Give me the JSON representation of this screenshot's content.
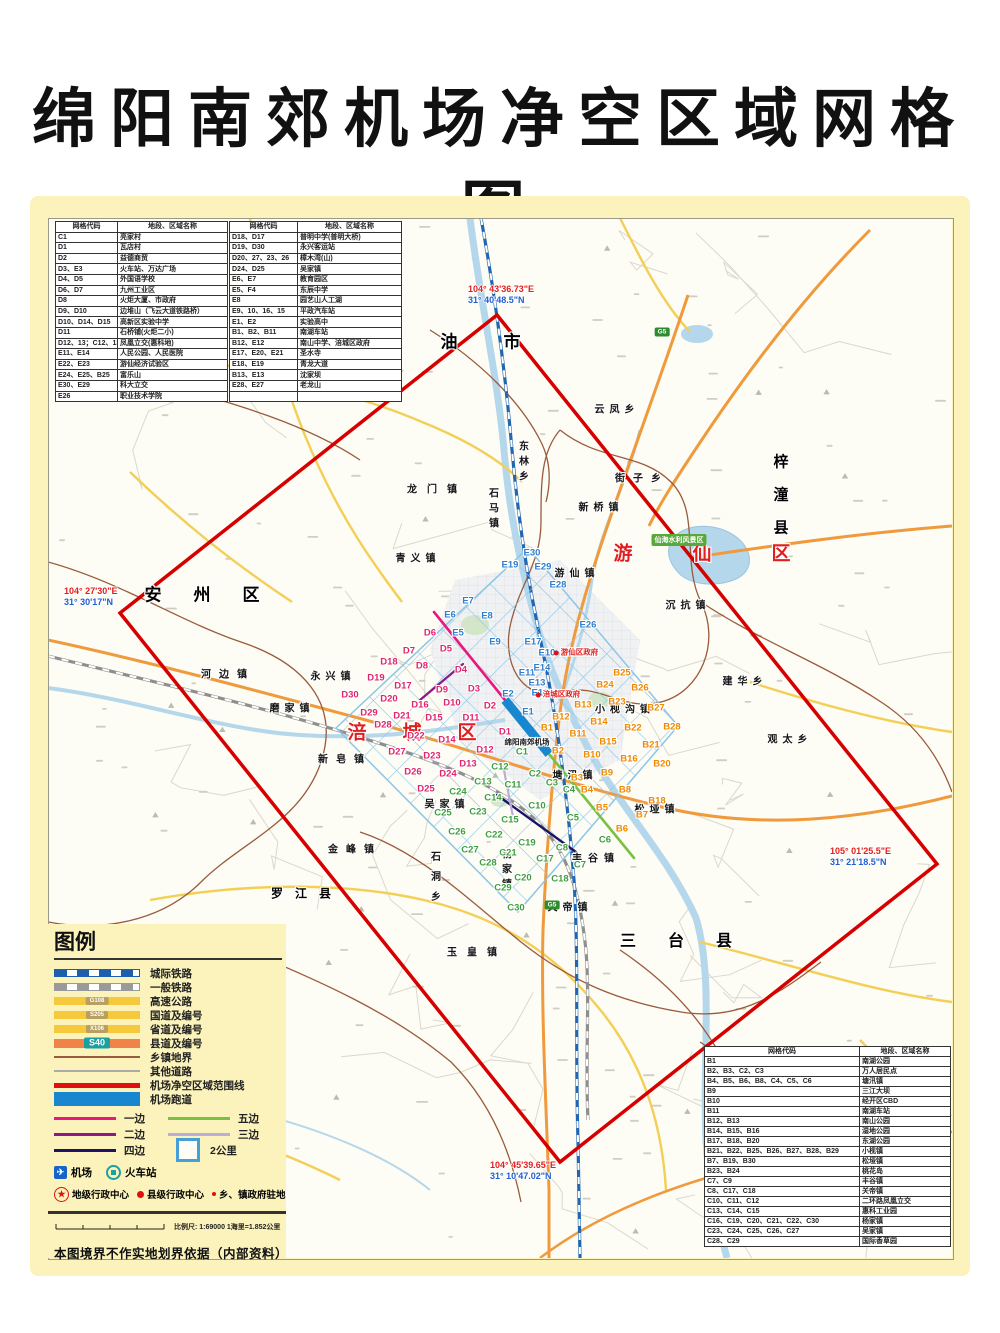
{
  "title": "绵阳南郊机场净空区域网格图",
  "palette": {
    "page_bg": "#fbf3bb",
    "boundary_red": "#d60000",
    "grid_blue": "#8cc6e6",
    "runway_blue": "#1887d0",
    "edge1_pink": "#e8197d",
    "edge2_purple": "#8b1a89",
    "edge3_lavender": "#b9aed6",
    "edge4_navy": "#1b1464",
    "edge5_green": "#7ac143",
    "d_label": "#e0256e",
    "e_label": "#2f7fd0",
    "b_label": "#ef8a00",
    "c_label": "#3f9e3f",
    "highway_orange": "#ef9a3c",
    "road_yellow": "#f6c93c",
    "river_blue": "#b5d7ec",
    "boundary_brown": "#9a5b3c"
  },
  "tables": {
    "headers": [
      "网格代码",
      "地段、区域名称"
    ],
    "top_left_rows": [
      [
        "C1",
        "亮家村"
      ],
      [
        "D1",
        "瓦店村"
      ],
      [
        "D2",
        "益德商贸"
      ],
      [
        "D3、E3",
        "火车站、万达广场"
      ],
      [
        "D4、D5",
        "外国语学校"
      ],
      [
        "D6、D7",
        "九州工业区"
      ],
      [
        "D8",
        "火炬大厦、市政府"
      ],
      [
        "D9、D10",
        "边堆山（飞云大道铁路桥）"
      ],
      [
        "D10、D14、D15",
        "高新区实验中学"
      ],
      [
        "D11",
        "石桥铺(火炬二小)"
      ],
      [
        "D12、13；C12、13",
        "凤凰立交(惠科地)"
      ],
      [
        "E11、E14",
        "人民公园、人民医院"
      ],
      [
        "E22、E23",
        "游仙经济试验区"
      ],
      [
        "E24、E25、B25",
        "富乐山"
      ],
      [
        "E30、E29",
        "科大立交"
      ],
      [
        "E26",
        "职业技术学院"
      ]
    ],
    "top_mid_rows": [
      [
        "D18、D17",
        "普明中学(普明大桥)"
      ],
      [
        "D19、D30",
        "永兴客运站"
      ],
      [
        "D20、27、23、26",
        "樟木湾(山)"
      ],
      [
        "D24、D25",
        "吴家镇"
      ],
      [
        "E6、E7",
        "教育园区"
      ],
      [
        "E5、F4",
        "东辰中学"
      ],
      [
        "E8",
        "园艺山人工湖"
      ],
      [
        "E9、10、16、15",
        "平政汽车站"
      ],
      [
        "E1、E2",
        "实验高中"
      ],
      [
        "B1、B2、B11",
        "南湖车站"
      ],
      [
        "B12、E12",
        "南山中学、涪城区政府"
      ],
      [
        "E17、E20、E21",
        "圣水寺"
      ],
      [
        "E18、E19",
        "青龙大道"
      ],
      [
        "B13、E13",
        "沈家坝"
      ],
      [
        "E28、E27",
        "老龙山"
      ],
      [
        "",
        ""
      ]
    ],
    "bottom_right_rows": [
      [
        "B1",
        "南湖公园"
      ],
      [
        "B2、B3、C2、C3",
        "万人居民点"
      ],
      [
        "B4、B5、B6、B8、C4、C5、C6",
        "塘汛镇"
      ],
      [
        "B9",
        "三江大坝"
      ],
      [
        "B10",
        "经开区CBD"
      ],
      [
        "B11",
        "南湖车站"
      ],
      [
        "B12、B13",
        "南山公园"
      ],
      [
        "B14、B15、B16",
        "湿地公园"
      ],
      [
        "B17、B18、B20",
        "东湖公园"
      ],
      [
        "B21、B22、B25、B26、B27、B28、B29",
        "小枧镇"
      ],
      [
        "B7、B19、B30",
        "松垭镇"
      ],
      [
        "B23、B24",
        "桃花岛"
      ],
      [
        "C7、C9",
        "丰谷镇"
      ],
      [
        "C8、C17、C18",
        "关帝镇"
      ],
      [
        "C10、C11、C12",
        "二环路凤凰立交"
      ],
      [
        "C13、C14、C15",
        "惠科工业园"
      ],
      [
        "C16、C19、C20、C21、C22、C30",
        "杨家镇"
      ],
      [
        "C23、C24、C25、C26、C27",
        "吴家镇"
      ],
      [
        "C28、C29",
        "国际香草园"
      ]
    ]
  },
  "legend": {
    "title": "图例",
    "lines": [
      {
        "label": "城际铁路",
        "type": "rail-blue"
      },
      {
        "label": "一般铁路",
        "type": "rail-gray"
      },
      {
        "label": "高速公路",
        "type": "road-yellow",
        "badge": "G108",
        "badgeType": "tan"
      },
      {
        "label": "国道及编号",
        "type": "road-yellow",
        "badge": "S205",
        "badgeType": "tan"
      },
      {
        "label": "省道及编号",
        "type": "road-yellow",
        "badge": "X106",
        "badgeType": "tan"
      },
      {
        "label": "县道及编号",
        "type": "road-orange",
        "badge": "S40",
        "badgeType": "teal"
      },
      {
        "label": "乡镇地界",
        "type": "line-brown"
      },
      {
        "label": "其他道路",
        "type": "line-gray"
      },
      {
        "label": "机场净空区域范围线",
        "type": "line-red"
      },
      {
        "label": "机场跑道",
        "type": "runway-sw"
      }
    ],
    "edges": [
      {
        "label": "一边",
        "color": "#e8197d"
      },
      {
        "label": "五边",
        "color": "#7ac143"
      },
      {
        "label": "二边",
        "color": "#8b1a89"
      },
      {
        "label": "三边",
        "color": "#b9aed6"
      },
      {
        "label": "四边",
        "color": "#1b1464"
      }
    ],
    "cell_label": "2公里",
    "poi": [
      {
        "label": "机场",
        "icon": "airport-icon"
      },
      {
        "label": "火车站",
        "icon": "train-station-icon"
      }
    ],
    "admin": [
      {
        "label": "地级行政中心",
        "icon": "star-icon"
      },
      {
        "label": "县级行政中心",
        "icon": "dot-large-icon"
      },
      {
        "label": "乡、镇政府驻地",
        "icon": "dot-small-icon"
      }
    ],
    "scale_label": "比例尺: 1:69000  1海里=1.852公里",
    "disclaimer": "本图境界不作实地划界依据（内部资料）"
  },
  "map": {
    "corner_coordinates": [
      {
        "e": "104° 43'36.73\"E",
        "n": "31° 40'48.5\"N",
        "x": 468,
        "y": 284
      },
      {
        "e": "104° 27'30\"E",
        "n": "31° 30'17\"N",
        "x": 64,
        "y": 586
      },
      {
        "e": "105° 01'25.5\"E",
        "n": "31° 21'18.5\"N",
        "x": 830,
        "y": 846
      },
      {
        "e": "104° 45'39.65\"E",
        "n": "31° 10'47.02\"N",
        "x": 490,
        "y": 1160
      }
    ],
    "regions": [
      {
        "t": "江油市",
        "x": 472,
        "y": 340,
        "fs": 17,
        "ls": 46,
        "cls": "county"
      },
      {
        "t": "安州区",
        "x": 218,
        "y": 593,
        "fs": 17,
        "ls": 32,
        "cls": "county"
      },
      {
        "t": "游仙区",
        "x": 732,
        "y": 552,
        "fs": 19,
        "ls": 60,
        "cls": "district"
      },
      {
        "t": "涪城区",
        "x": 430,
        "y": 731,
        "fs": 19,
        "ls": 36,
        "cls": "district"
      },
      {
        "t": "梓潼县",
        "x": 780,
        "y": 503,
        "fs": 15,
        "ls": 18,
        "cls": "county",
        "v": 1
      },
      {
        "t": "三台县",
        "x": 692,
        "y": 939,
        "fs": 16,
        "ls": 32,
        "cls": "county"
      },
      {
        "t": "罗江县",
        "x": 307,
        "y": 893,
        "fs": 12,
        "ls": 12,
        "cls": "county"
      }
    ],
    "towns": [
      {
        "t": "云凤乡",
        "x": 617,
        "y": 408
      },
      {
        "t": "东林乡",
        "x": 522,
        "y": 463,
        "v": 1
      },
      {
        "t": "龙门镇",
        "x": 437,
        "y": 488,
        "ls": 10
      },
      {
        "t": "石马镇",
        "x": 492,
        "y": 510,
        "v": 1
      },
      {
        "t": "新桥镇",
        "x": 601,
        "y": 506
      },
      {
        "t": "街子乡",
        "x": 642,
        "y": 477,
        "ls": 8
      },
      {
        "t": "青义镇",
        "x": 418,
        "y": 557
      },
      {
        "t": "游仙镇",
        "x": 577,
        "y": 572
      },
      {
        "t": "沉抗镇",
        "x": 688,
        "y": 604
      },
      {
        "t": "河边镇",
        "x": 228,
        "y": 673,
        "ls": 8
      },
      {
        "t": "永兴镇",
        "x": 333,
        "y": 675
      },
      {
        "t": "磨家镇",
        "x": 292,
        "y": 707
      },
      {
        "t": "新皂镇",
        "x": 345,
        "y": 758,
        "ls": 8
      },
      {
        "t": "吴家镇",
        "x": 447,
        "y": 803
      },
      {
        "t": "金峰镇",
        "x": 355,
        "y": 848,
        "ls": 8
      },
      {
        "t": "石洞乡",
        "x": 434,
        "y": 881,
        "v": 1,
        "ls": 10
      },
      {
        "t": "玉皇镇",
        "x": 477,
        "y": 951,
        "ls": 10
      },
      {
        "t": "杨家镇",
        "x": 505,
        "y": 871,
        "v": 1
      },
      {
        "t": "丰谷镇",
        "x": 596,
        "y": 857,
        "ls": 6
      },
      {
        "t": "关帝镇",
        "x": 570,
        "y": 906
      },
      {
        "t": "塘汛镇",
        "x": 575,
        "y": 774
      },
      {
        "t": "小枧沟镇",
        "x": 625,
        "y": 708
      },
      {
        "t": "松垭镇",
        "x": 657,
        "y": 808
      },
      {
        "t": "建华乡",
        "x": 745,
        "y": 680
      },
      {
        "t": "观太乡",
        "x": 790,
        "y": 738
      }
    ],
    "special": [
      {
        "t": "仙海水利风景区",
        "x": 679,
        "y": 540,
        "cls": "green-badge"
      },
      {
        "t": "绵阳南郊机场",
        "x": 527,
        "y": 742,
        "cls": "tiny-black"
      },
      {
        "t": "游仙区政府",
        "x": 576,
        "y": 652,
        "cls": "tiny-red",
        "dot": 1
      },
      {
        "t": "涪城区政府",
        "x": 558,
        "y": 694,
        "cls": "tiny-red",
        "dot": 1
      }
    ],
    "road_badges": [
      {
        "t": "G5",
        "x": 662,
        "y": 332
      },
      {
        "t": "G5",
        "x": 552,
        "y": 905
      }
    ],
    "grid_labels": {
      "d": [
        [
          "D1",
          505,
          732
        ],
        [
          "D2",
          490,
          706
        ],
        [
          "D3",
          474,
          689
        ],
        [
          "D4",
          461,
          670
        ],
        [
          "D5",
          446,
          649
        ],
        [
          "D6",
          430,
          633
        ],
        [
          "D7",
          409,
          651
        ],
        [
          "D8",
          422,
          666
        ],
        [
          "D9",
          442,
          690
        ],
        [
          "D10",
          452,
          703
        ],
        [
          "D11",
          471,
          718
        ],
        [
          "D12",
          485,
          750
        ],
        [
          "D13",
          468,
          764
        ],
        [
          "D14",
          447,
          740
        ],
        [
          "D15",
          434,
          718
        ],
        [
          "D16",
          420,
          705
        ],
        [
          "D17",
          403,
          686
        ],
        [
          "D18",
          389,
          662
        ],
        [
          "D19",
          376,
          678
        ],
        [
          "D20",
          389,
          699
        ],
        [
          "D21",
          402,
          716
        ],
        [
          "D22",
          416,
          736
        ],
        [
          "D23",
          432,
          756
        ],
        [
          "D24",
          448,
          774
        ],
        [
          "D25",
          426,
          789
        ],
        [
          "D26",
          413,
          772
        ],
        [
          "D27",
          397,
          752
        ],
        [
          "D28",
          383,
          725
        ],
        [
          "D29",
          369,
          713
        ],
        [
          "D30",
          350,
          695
        ]
      ],
      "e": [
        [
          "E1",
          528,
          712
        ],
        [
          "E2",
          508,
          694
        ],
        [
          "E5",
          458,
          633
        ],
        [
          "E6",
          450,
          615
        ],
        [
          "E7",
          468,
          601
        ],
        [
          "E8",
          487,
          616
        ],
        [
          "E9",
          495,
          642
        ],
        [
          "E10",
          547,
          653
        ],
        [
          "E11",
          527,
          673
        ],
        [
          "E12",
          540,
          693
        ],
        [
          "E13",
          537,
          683
        ],
        [
          "E14",
          542,
          668
        ],
        [
          "E17",
          533,
          642
        ],
        [
          "E19",
          510,
          565
        ],
        [
          "E26",
          588,
          625
        ],
        [
          "E28",
          558,
          585
        ],
        [
          "E29",
          543,
          567
        ],
        [
          "E30",
          532,
          553
        ]
      ],
      "b": [
        [
          "B1",
          547,
          728
        ],
        [
          "B2",
          558,
          751
        ],
        [
          "B3",
          577,
          778
        ],
        [
          "B4",
          587,
          790
        ],
        [
          "B5",
          602,
          808
        ],
        [
          "B6",
          622,
          829
        ],
        [
          "B7",
          642,
          815
        ],
        [
          "B8",
          625,
          790
        ],
        [
          "B9",
          607,
          773
        ],
        [
          "B10",
          592,
          755
        ],
        [
          "B11",
          578,
          734
        ],
        [
          "B12",
          561,
          717
        ],
        [
          "B13",
          583,
          705
        ],
        [
          "B14",
          599,
          722
        ],
        [
          "B15",
          608,
          742
        ],
        [
          "B16",
          629,
          759
        ],
        [
          "B18",
          657,
          801
        ],
        [
          "B20",
          662,
          764
        ],
        [
          "B21",
          651,
          745
        ],
        [
          "B22",
          633,
          728
        ],
        [
          "B23",
          617,
          702
        ],
        [
          "B24",
          605,
          685
        ],
        [
          "B25",
          622,
          673
        ],
        [
          "B26",
          640,
          688
        ],
        [
          "B27",
          656,
          708
        ],
        [
          "B28",
          672,
          727
        ]
      ],
      "c": [
        [
          "C1",
          522,
          752
        ],
        [
          "C2",
          535,
          774
        ],
        [
          "C3",
          552,
          783
        ],
        [
          "C4",
          569,
          790
        ],
        [
          "C5",
          573,
          818
        ],
        [
          "C6",
          605,
          840
        ],
        [
          "C7",
          580,
          865
        ],
        [
          "C8",
          562,
          848
        ],
        [
          "C10",
          537,
          806
        ],
        [
          "C11",
          513,
          785
        ],
        [
          "C12",
          500,
          767
        ],
        [
          "C13",
          483,
          782
        ],
        [
          "C14",
          493,
          798
        ],
        [
          "C15",
          510,
          820
        ],
        [
          "C17",
          545,
          859
        ],
        [
          "C18",
          560,
          879
        ],
        [
          "C19",
          527,
          843
        ],
        [
          "C20",
          523,
          878
        ],
        [
          "C21",
          508,
          853
        ],
        [
          "C22",
          494,
          835
        ],
        [
          "C23",
          478,
          812
        ],
        [
          "C24",
          458,
          792
        ],
        [
          "C25",
          443,
          813
        ],
        [
          "C26",
          457,
          832
        ],
        [
          "C27",
          470,
          850
        ],
        [
          "C28",
          488,
          863
        ],
        [
          "C29",
          503,
          888
        ],
        [
          "C30",
          516,
          908
        ]
      ]
    }
  }
}
